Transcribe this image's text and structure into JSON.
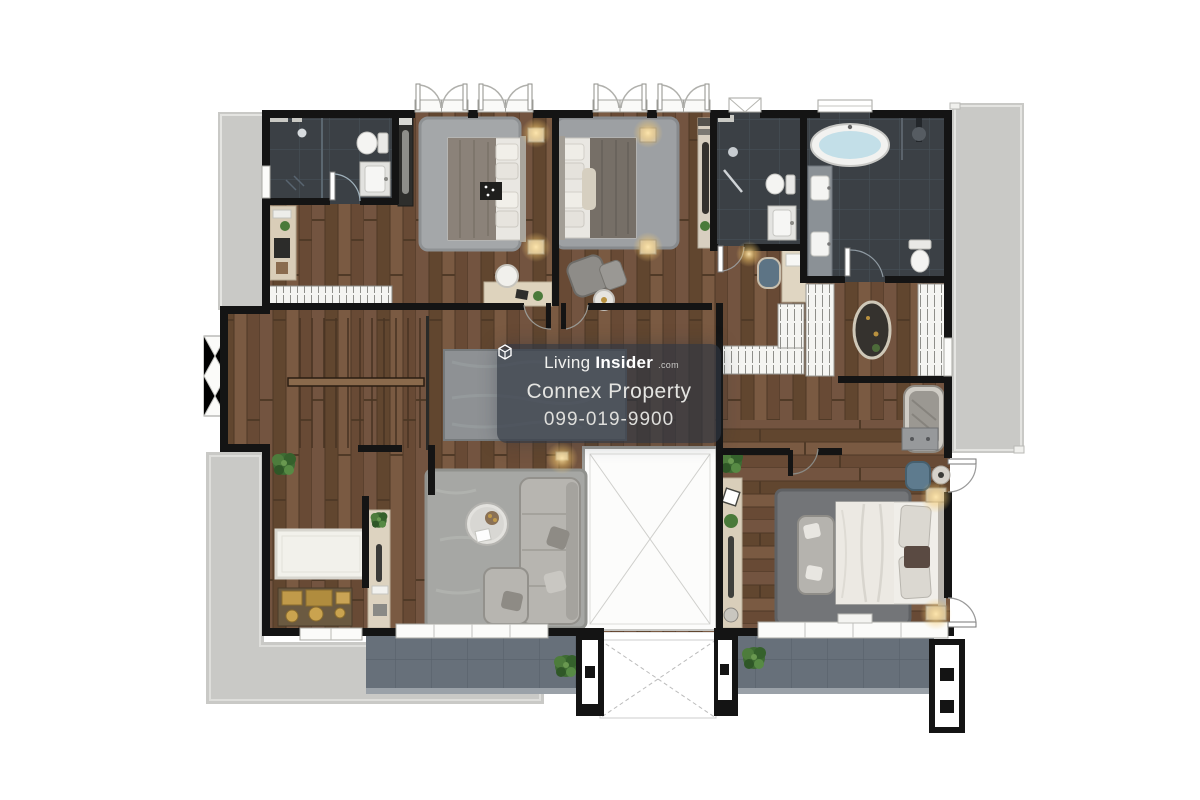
{
  "image": {
    "description": "Top-down 3D rendered residential floor plan (upper floor) on white background",
    "background": "#ffffff"
  },
  "watermark": {
    "logo_icon": "living-insider-cube-icon",
    "brand_prefix": "Living",
    "brand_bold": "Insider",
    "brand_tld": ".com",
    "company": "Connex Property",
    "phone": "099-019-9900"
  },
  "visible_areas": [
    "balcony-top-left",
    "bathroom-top-left",
    "bedroom-1",
    "bedroom-2",
    "jack-and-jill-bathroom",
    "master-bathroom",
    "walk-in-closet",
    "staircase",
    "hallway",
    "family-area",
    "void-open-to-below",
    "guest-luggage-corner",
    "master-bedroom",
    "terrace-right",
    "terrace-bottom-left",
    "balcony-bottom-center",
    "balcony-bottom-right"
  ],
  "furniture_icons": [
    "double-bed",
    "area-rug",
    "desk-with-chair",
    "armchair-with-ottoman",
    "sectional-sofa",
    "round-coffee-table",
    "freestanding-bathtub",
    "toilet",
    "vanity-sink",
    "double-vanity",
    "shower-head",
    "wardrobe",
    "dressing-ottoman",
    "vanity-stool",
    "chaise-daybed",
    "dresser",
    "luggage-trunks",
    "console-table",
    "potted-plant",
    "wall-lamp",
    "staircase-treads"
  ],
  "colors": {
    "wall": "#141414",
    "wood": "#6b4e3a",
    "tile_dark": "#3b4045",
    "concrete": "#c9c9c6",
    "balcony_tile": "#67707a",
    "rug_gray": "#a3a5a3",
    "rug_dark": "#737578",
    "rug_white": "#f2f1eb",
    "sofa": "#b7b5b0",
    "bed_white": "#edebe5",
    "duvet_taupe": "#8b8279",
    "bath_water": "#c3dfe8",
    "lamp_glow": "#ffd98a",
    "gold_luggage": "#c09a4a",
    "plant_green": "#4a7a3a",
    "watermark_bg": "rgba(47,55,66,0.68)",
    "watermark_text": "#e8e8e6"
  }
}
